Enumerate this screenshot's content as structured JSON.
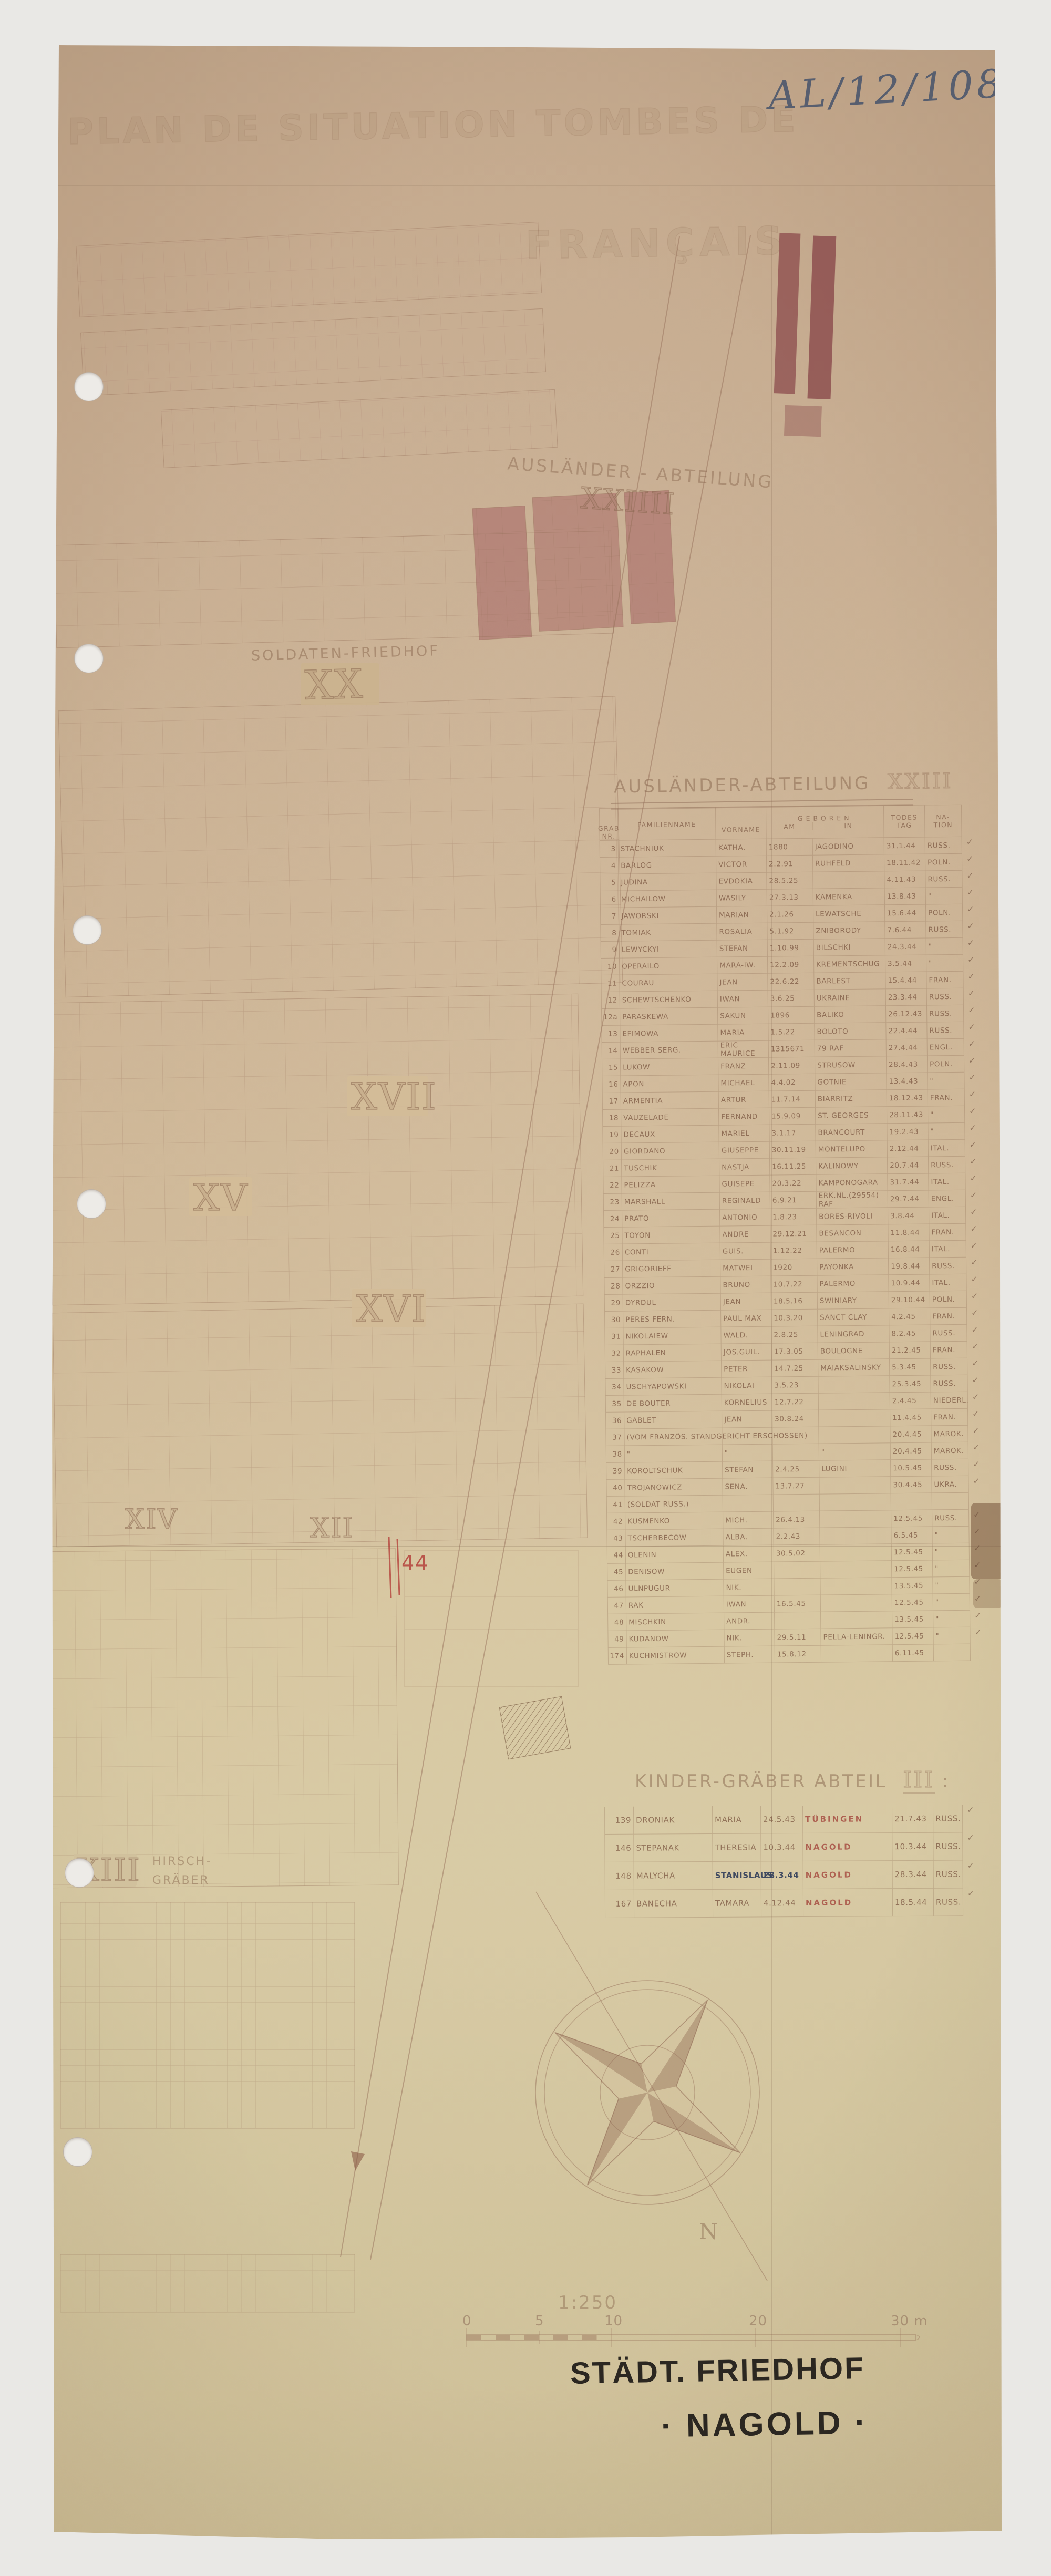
{
  "ref_number": "AL/12/108",
  "faint_title": {
    "line1": "PLAN DE SITUATION TOMBES DE",
    "line2": "FRANÇAIS"
  },
  "map": {
    "auslaender_area_label": "AUSLÄNDER - ABTEILUNG",
    "auslaender_area_numeral": "XXIIII",
    "soldaten_label": "SOLDATEN-FRIEDHOF",
    "soldaten_numeral": "XX",
    "section_xvii": "XVII",
    "section_xv": "XV",
    "section_xvi": "XVI",
    "section_xiv": "XIV",
    "section_xii": "XII",
    "section_xiii": "XIII",
    "hirsch_line1": "HIRSCH-",
    "hirsch_line2": "GRÄBER",
    "red_annotation": "44",
    "compass_north": "N"
  },
  "auslaender_table": {
    "title": "AUSLÄNDER-ABTEILUNG",
    "title_numeral": "XXIII",
    "headers": {
      "grab1": "GRAB",
      "grab2": "NR.",
      "fam": "FAMILIENNAME",
      "vor": "VORNAME",
      "geb": "GEBOREN",
      "geb_am": "AM",
      "geb_in": "IN",
      "tod1": "TODES",
      "tod2": "TAG",
      "nat1": "NA-",
      "nat2": "TION"
    },
    "rows": [
      {
        "nr": "3",
        "name": "STACHNIUK",
        "vorname": "KATHA.",
        "geb_am": "1880",
        "geb_in": "JAGODINO",
        "tod": "31.1.44",
        "nation": "RUSS.",
        "check": true
      },
      {
        "nr": "4",
        "name": "BARLOG",
        "vorname": "VICTOR",
        "geb_am": "2.2.91",
        "geb_in": "RUHFELD",
        "tod": "18.11.42",
        "nation": "POLN.",
        "check": true
      },
      {
        "nr": "5",
        "name": "JUDINA",
        "vorname": "EVDOKIA",
        "geb_am": "28.5.25",
        "geb_in": "",
        "tod": "4.11.43",
        "nation": "RUSS.",
        "check": true
      },
      {
        "nr": "6",
        "name": "MICHAILOW",
        "vorname": "WASILY",
        "geb_am": "27.3.13",
        "geb_in": "KAMENKA",
        "tod": "13.8.43",
        "nation": "\"",
        "check": true
      },
      {
        "nr": "7",
        "name": "JAWORSKI",
        "vorname": "MARIAN",
        "geb_am": "2.1.26",
        "geb_in": "LEWATSCHE",
        "tod": "15.6.44",
        "nation": "POLN.",
        "check": true
      },
      {
        "nr": "8",
        "name": "TOMIAK",
        "vorname": "ROSALIA",
        "geb_am": "5.1.92",
        "geb_in": "ZNIBORODY",
        "tod": "7.6.44",
        "nation": "RUSS.",
        "check": true
      },
      {
        "nr": "9",
        "name": "LEWYCKYI",
        "vorname": "STEFAN",
        "geb_am": "1.10.99",
        "geb_in": "BILSCHKI",
        "tod": "24.3.44",
        "nation": "\"",
        "check": true
      },
      {
        "nr": "10",
        "name": "OPERAILO",
        "vorname": "MARA-IW.",
        "geb_am": "12.2.09",
        "geb_in": "KREMENTSCHUG",
        "tod": "3.5.44",
        "nation": "\"",
        "check": true
      },
      {
        "nr": "11",
        "name": "COURAU",
        "vorname": "JEAN",
        "geb_am": "22.6.22",
        "geb_in": "BARLEST",
        "tod": "15.4.44",
        "nation": "FRAN.",
        "check": true
      },
      {
        "nr": "12",
        "name": "SCHEWTSCHENKO",
        "vorname": "IWAN",
        "geb_am": "3.6.25",
        "geb_in": "UKRAINE",
        "tod": "23.3.44",
        "nation": "RUSS.",
        "check": true
      },
      {
        "nr": "12a",
        "name": "PARASKEWA",
        "vorname": "SAKUN",
        "geb_am": "1896",
        "geb_in": "BALIKO",
        "tod": "26.12.43",
        "nation": "RUSS.",
        "check": true
      },
      {
        "nr": "13",
        "name": "EFIMOWA",
        "vorname": "MARIA",
        "geb_am": "1.5.22",
        "geb_in": "BOLOTO",
        "tod": "22.4.44",
        "nation": "RUSS.",
        "check": true
      },
      {
        "nr": "14",
        "name": "WEBBER SERG.",
        "vorname": "ERIC MAURICE",
        "geb_am": "1315671",
        "geb_in": "79 RAF",
        "tod": "27.4.44",
        "nation": "ENGL.",
        "check": true
      },
      {
        "nr": "15",
        "name": "LUKOW",
        "vorname": "FRANZ",
        "geb_am": "2.11.09",
        "geb_in": "STRUSOW",
        "tod": "28.4.43",
        "nation": "POLN.",
        "check": true
      },
      {
        "nr": "16",
        "name": "APON",
        "vorname": "MICHAEL",
        "geb_am": "4.4.02",
        "geb_in": "GOTNIE",
        "tod": "13.4.43",
        "nation": "\"",
        "check": true
      },
      {
        "nr": "17",
        "name": "ARMENTIA",
        "vorname": "ARTUR",
        "geb_am": "11.7.14",
        "geb_in": "BIARRITZ",
        "tod": "18.12.43",
        "nation": "FRAN.",
        "check": true
      },
      {
        "nr": "18",
        "name": "VAUZELADE",
        "vorname": "FERNAND",
        "geb_am": "15.9.09",
        "geb_in": "ST. GEORGES",
        "tod": "28.11.43",
        "nation": "\"",
        "check": true
      },
      {
        "nr": "19",
        "name": "DECAUX",
        "vorname": "MARIEL",
        "geb_am": "3.1.17",
        "geb_in": "BRANCOURT",
        "tod": "19.2.43",
        "nation": "\"",
        "check": true
      },
      {
        "nr": "20",
        "name": "GIORDANO",
        "vorname": "GIUSEPPE",
        "geb_am": "30.11.19",
        "geb_in": "MONTELUPO",
        "tod": "2.12.44",
        "nation": "ITAL.",
        "check": true
      },
      {
        "nr": "21",
        "name": "TUSCHIK",
        "vorname": "NASTJA",
        "geb_am": "16.11.25",
        "geb_in": "KALINOWY",
        "tod": "20.7.44",
        "nation": "RUSS.",
        "check": true
      },
      {
        "nr": "22",
        "name": "PELIZZA",
        "vorname": "GUISEPE",
        "geb_am": "20.3.22",
        "geb_in": "KAMPONOGARA",
        "tod": "31.7.44",
        "nation": "ITAL.",
        "check": true
      },
      {
        "nr": "23",
        "name": "MARSHALL",
        "vorname": "REGINALD",
        "geb_am": "6.9.21",
        "geb_in": "ERK.NL.(29554) RAF",
        "tod": "29.7.44",
        "nation": "ENGL.",
        "check": true
      },
      {
        "nr": "24",
        "name": "PRATO",
        "vorname": "ANTONIO",
        "geb_am": "1.8.23",
        "geb_in": "BORES-RIVOLI",
        "tod": "3.8.44",
        "nation": "ITAL.",
        "check": true
      },
      {
        "nr": "25",
        "name": "TOYON",
        "vorname": "ANDRE",
        "geb_am": "29.12.21",
        "geb_in": "BESANCON",
        "tod": "11.8.44",
        "nation": "FRAN.",
        "check": true
      },
      {
        "nr": "26",
        "name": "CONTI",
        "vorname": "GUIS.",
        "geb_am": "1.12.22",
        "geb_in": "PALERMO",
        "tod": "16.8.44",
        "nation": "ITAL.",
        "check": true
      },
      {
        "nr": "27",
        "name": "GRIGORIEFF",
        "vorname": "MATWEI",
        "geb_am": "1920",
        "geb_in": "PAYONKA",
        "tod": "19.8.44",
        "nation": "RUSS.",
        "check": true
      },
      {
        "nr": "28",
        "name": "ORZZIO",
        "vorname": "BRUNO",
        "geb_am": "10.7.22",
        "geb_in": "PALERMO",
        "tod": "10.9.44",
        "nation": "ITAL.",
        "check": true
      },
      {
        "nr": "29",
        "name": "DYRDUL",
        "vorname": "JEAN",
        "geb_am": "18.5.16",
        "geb_in": "SWINIARY",
        "tod": "29.10.44",
        "nation": "POLN.",
        "check": true
      },
      {
        "nr": "30",
        "name": "PERES FERN.",
        "vorname": "PAUL MAX",
        "geb_am": "10.3.20",
        "geb_in": "SANCT CLAY",
        "tod": "4.2.45",
        "nation": "FRAN.",
        "check": true
      },
      {
        "nr": "31",
        "name": "NIKOLAIEW",
        "vorname": "WALD.",
        "geb_am": "2.8.25",
        "geb_in": "LENINGRAD",
        "tod": "8.2.45",
        "nation": "RUSS.",
        "check": true
      },
      {
        "nr": "32",
        "name": "RAPHALEN",
        "vorname": "JOS.GUIL.",
        "geb_am": "17.3.05",
        "geb_in": "BOULOGNE",
        "tod": "21.2.45",
        "nation": "FRAN.",
        "check": true
      },
      {
        "nr": "33",
        "name": "KASAKOW",
        "vorname": "PETER",
        "geb_am": "14.7.25",
        "geb_in": "MAIAKSALINSKY",
        "tod": "5.3.45",
        "nation": "RUSS.",
        "check": true
      },
      {
        "nr": "34",
        "name": "USCHYAPOWSKI",
        "vorname": "NIKOLAI",
        "geb_am": "3.5.23",
        "geb_in": "",
        "tod": "25.3.45",
        "nation": "RUSS.",
        "check": true
      },
      {
        "nr": "35",
        "name": "DE BOUTER",
        "vorname": "KORNELIUS",
        "geb_am": "12.7.22",
        "geb_in": "",
        "tod": "2.4.45",
        "nation": "NIEDERL.",
        "check": true
      },
      {
        "nr": "36",
        "name": "GABLET",
        "vorname": "JEAN",
        "geb_am": "30.8.24",
        "geb_in": "",
        "tod": "11.4.45",
        "nation": "FRAN.",
        "check": true
      },
      {
        "nr": "37",
        "name": "(VOM FRANZÖS. STANDGERICHT ERSCHOSSEN)",
        "vorname": "",
        "geb_am": "",
        "geb_in": "",
        "tod": "20.4.45",
        "nation": "MAROK.",
        "check": true
      },
      {
        "nr": "38",
        "name": "\"",
        "vorname": "\"",
        "geb_am": "",
        "geb_in": "\"",
        "tod": "20.4.45",
        "nation": "MAROK.",
        "check": true
      },
      {
        "nr": "39",
        "name": "KOROLTSCHUK",
        "vorname": "STEFAN",
        "geb_am": "2.4.25",
        "geb_in": "LUGINI",
        "tod": "10.5.45",
        "nation": "RUSS.",
        "check": true
      },
      {
        "nr": "40",
        "name": "TROJANOWICZ",
        "vorname": "SENA.",
        "geb_am": "13.7.27",
        "geb_in": "",
        "tod": "30.4.45",
        "nation": "UKRA.",
        "check": true
      },
      {
        "nr": "41",
        "name": "(SOLDAT RUSS.)",
        "vorname": "",
        "geb_am": "",
        "geb_in": "",
        "tod": "",
        "nation": "",
        "check": false
      },
      {
        "nr": "42",
        "name": "KUSMENKO",
        "vorname": "MICH.",
        "geb_am": "26.4.13",
        "geb_in": "",
        "tod": "12.5.45",
        "nation": "RUSS.",
        "check": true
      },
      {
        "nr": "43",
        "name": "TSCHERBECOW",
        "vorname": "ALBA.",
        "geb_am": "2.2.43",
        "geb_in": "",
        "tod": "6.5.45",
        "nation": "\"",
        "check": true
      },
      {
        "nr": "44",
        "name": "OLENIN",
        "vorname": "ALEX.",
        "geb_am": "30.5.02",
        "geb_in": "",
        "tod": "12.5.45",
        "nation": "\"",
        "check": true
      },
      {
        "nr": "45",
        "name": "DENISOW",
        "vorname": "EUGEN",
        "geb_am": "",
        "geb_in": "",
        "tod": "12.5.45",
        "nation": "\"",
        "check": true
      },
      {
        "nr": "46",
        "name": "ULNPUGUR",
        "vorname": "NIK.",
        "geb_am": "",
        "geb_in": "",
        "tod": "13.5.45",
        "nation": "\"",
        "check": true
      },
      {
        "nr": "47",
        "name": "RAK",
        "vorname": "IWAN",
        "geb_am": "16.5.45",
        "geb_in": "",
        "tod": "12.5.45",
        "nation": "\"",
        "check": true
      },
      {
        "nr": "48",
        "name": "MISCHKIN",
        "vorname": "ANDR.",
        "geb_am": "",
        "geb_in": "",
        "tod": "13.5.45",
        "nation": "\"",
        "check": true
      },
      {
        "nr": "49",
        "name": "KUDANOW",
        "vorname": "NIK.",
        "geb_am": "29.5.11",
        "geb_in": "PELLA-LENINGR.",
        "tod": "12.5.45",
        "nation": "\"",
        "check": true
      },
      {
        "nr": "174",
        "name": "KUCHMISTROW",
        "vorname": "STEPH.",
        "geb_am": "15.8.12",
        "geb_in": "",
        "tod": "6.11.45",
        "nation": "",
        "check": false
      }
    ]
  },
  "kinder_table": {
    "title": "KINDER-GRÄBER ABTEIL",
    "title_numeral": "III",
    "title_colon": ":",
    "rows": [
      {
        "nr": "139",
        "name": "DRONIAK",
        "vorname": "MARIA",
        "geb": "24.5.43",
        "ort": "TÜBINGEN",
        "tod": "21.7.43",
        "nation": "RUSS.",
        "ink": false,
        "check": true
      },
      {
        "nr": "146",
        "name": "STEPANAK",
        "vorname": "THERESIA",
        "geb": "10.3.44",
        "ort": "NAGOLD",
        "tod": "10.3.44",
        "nation": "RUSS.",
        "ink": false,
        "check": true
      },
      {
        "nr": "148",
        "name": "MALYCHA",
        "vorname": "STANISLAUS",
        "geb": "28.3.44",
        "ort": "NAGOLD",
        "tod": "28.3.44",
        "nation": "RUSS.",
        "ink": true,
        "check": true
      },
      {
        "nr": "167",
        "name": "BANECHA",
        "vorname": "TAMARA",
        "geb": "4.12.44",
        "ort": "NAGOLD",
        "tod": "18.5.44",
        "nation": "RUSS.",
        "ink": false,
        "check": true
      }
    ]
  },
  "scale": {
    "ratio": "1:250",
    "ticks": [
      "0",
      "5",
      "10",
      "20",
      "30 m"
    ]
  },
  "footer": {
    "line1": "STÄDT. FRIEDHOF",
    "line2": "· NAGOLD ·"
  },
  "colors": {
    "paper": "#cdb697",
    "pencil": "#805d46",
    "red_pencil": "#b5423c",
    "red_fill": "#9e5258",
    "ink_black": "#2b2721",
    "ink_blue": "#39455e"
  }
}
